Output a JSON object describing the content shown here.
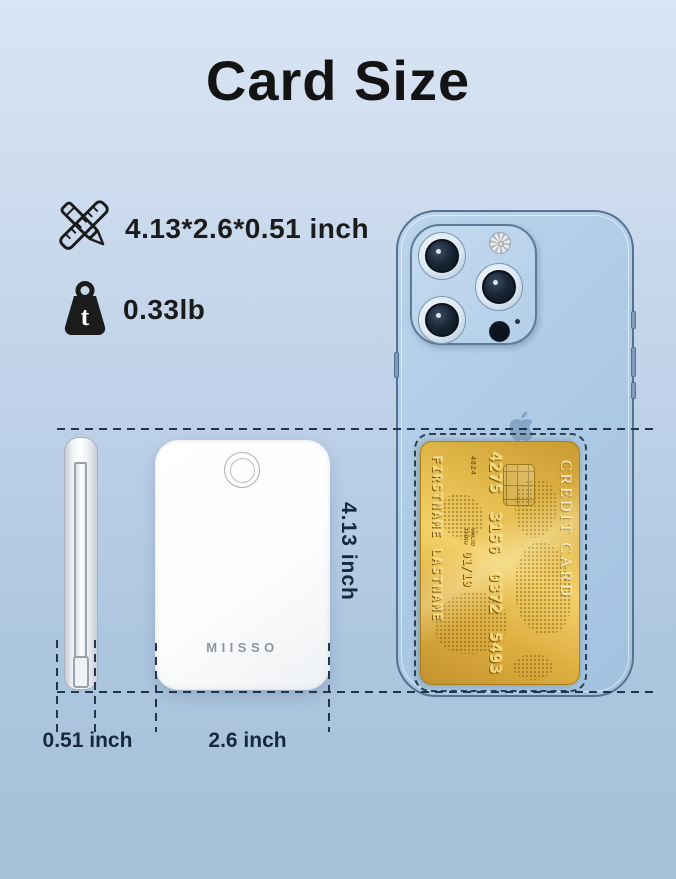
{
  "title": "Card Size",
  "specs": {
    "dimensions": "4.13*2.6*0.51 inch",
    "weight": "0.33lb",
    "weight_icon_letter": "t"
  },
  "dimension_labels": {
    "height": "4.13 inch",
    "thickness": "0.51 inch",
    "width": "2.6 inch"
  },
  "powerbank": {
    "brand": "MIISSO"
  },
  "credit_card": {
    "label": "CREDIT CARD",
    "bin": "4824",
    "number": "4275 3156 0372 5493",
    "valid_label": "VALID",
    "thru_label": "THRU",
    "expiry": "01/19",
    "holder": "FIRSTNAME LASTNAME"
  },
  "icons": {
    "spec_dimensions": "ruler-pencil-icon",
    "spec_weight": "weight-icon",
    "phone_brand": "apple-logo-icon",
    "camera": "camera-lens-icon",
    "flash": "flash-icon"
  },
  "colors": {
    "background_top": "#d9e5f4",
    "background_bottom": "#a7c0da",
    "dash": "#24364a",
    "text_dark": "#1a1a1a",
    "dim_text": "#16293c",
    "phone_body": "#aecbe6",
    "card_gold": "#e2b648",
    "brand_gray": "#8e959c"
  }
}
